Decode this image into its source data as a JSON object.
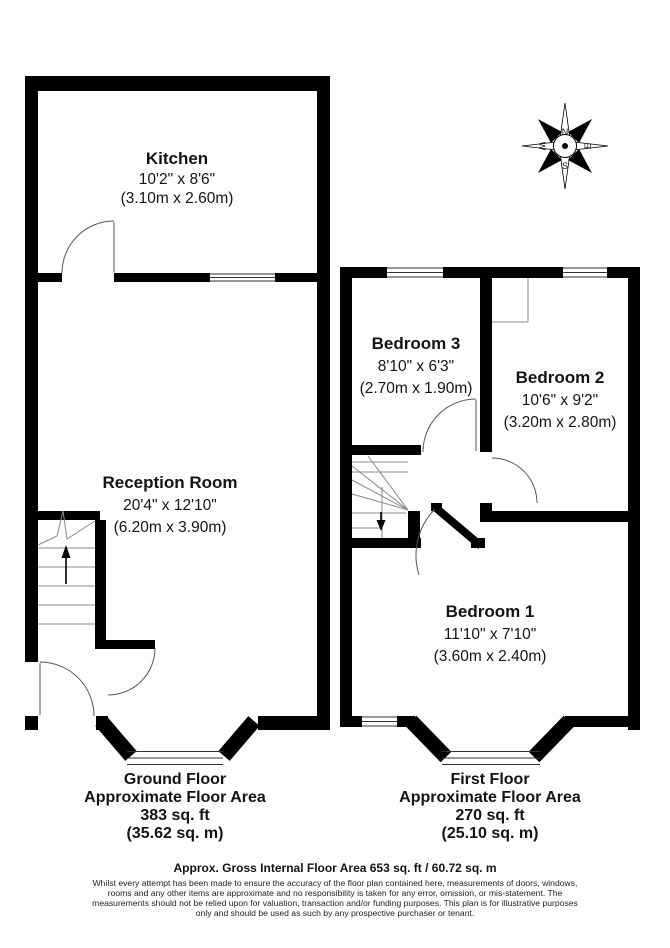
{
  "compass": {
    "north": "N",
    "south": "S",
    "east": "E",
    "west": "W"
  },
  "ground_floor": {
    "kitchen": {
      "name": "Kitchen",
      "imperial": "10'2\" x 8'6\"",
      "metric": "(3.10m x 2.60m)"
    },
    "reception": {
      "name": "Reception Room",
      "imperial": "20'4\" x 12'10\"",
      "metric": "(6.20m x 3.90m)"
    },
    "label": {
      "line1": "Ground Floor",
      "line2": "Approximate Floor Area",
      "line3": "383 sq. ft",
      "line4": "(35.62 sq. m)"
    }
  },
  "first_floor": {
    "bedroom3": {
      "name": "Bedroom 3",
      "imperial": "8'10\" x 6'3\"",
      "metric": "(2.70m x 1.90m)"
    },
    "bedroom2": {
      "name": "Bedroom 2",
      "imperial": "10'6\" x 9'2\"",
      "metric": "(3.20m x 2.80m)"
    },
    "bedroom1": {
      "name": "Bedroom 1",
      "imperial": "11'10\" x 7'10\"",
      "metric": "(3.60m x 2.40m)"
    },
    "label": {
      "line1": "First Floor",
      "line2": "Approximate Floor Area",
      "line3": "270 sq. ft",
      "line4": "(25.10 sq. m)"
    }
  },
  "footer": {
    "title": "Approx. Gross Internal Floor Area 653 sq. ft / 60.72 sq. m",
    "line1": "Whilst every attempt has been made to ensure the accuracy of the floor plan contained here, measurements of doors, windows,",
    "line2": "rooms and any other items are approximate and no responsibility is taken for any error, omission, or mis-statement. The",
    "line3": "measurements should not be relied upon for valuation, transaction and/or funding purposes. This plan is for illustrative purposes",
    "line4": "only and should be used as such by any prospective purchaser or tenant."
  },
  "colors": {
    "wall": "#000000",
    "background": "#ffffff",
    "door_arc": "#555555",
    "stair_line": "#8a8a8a"
  }
}
